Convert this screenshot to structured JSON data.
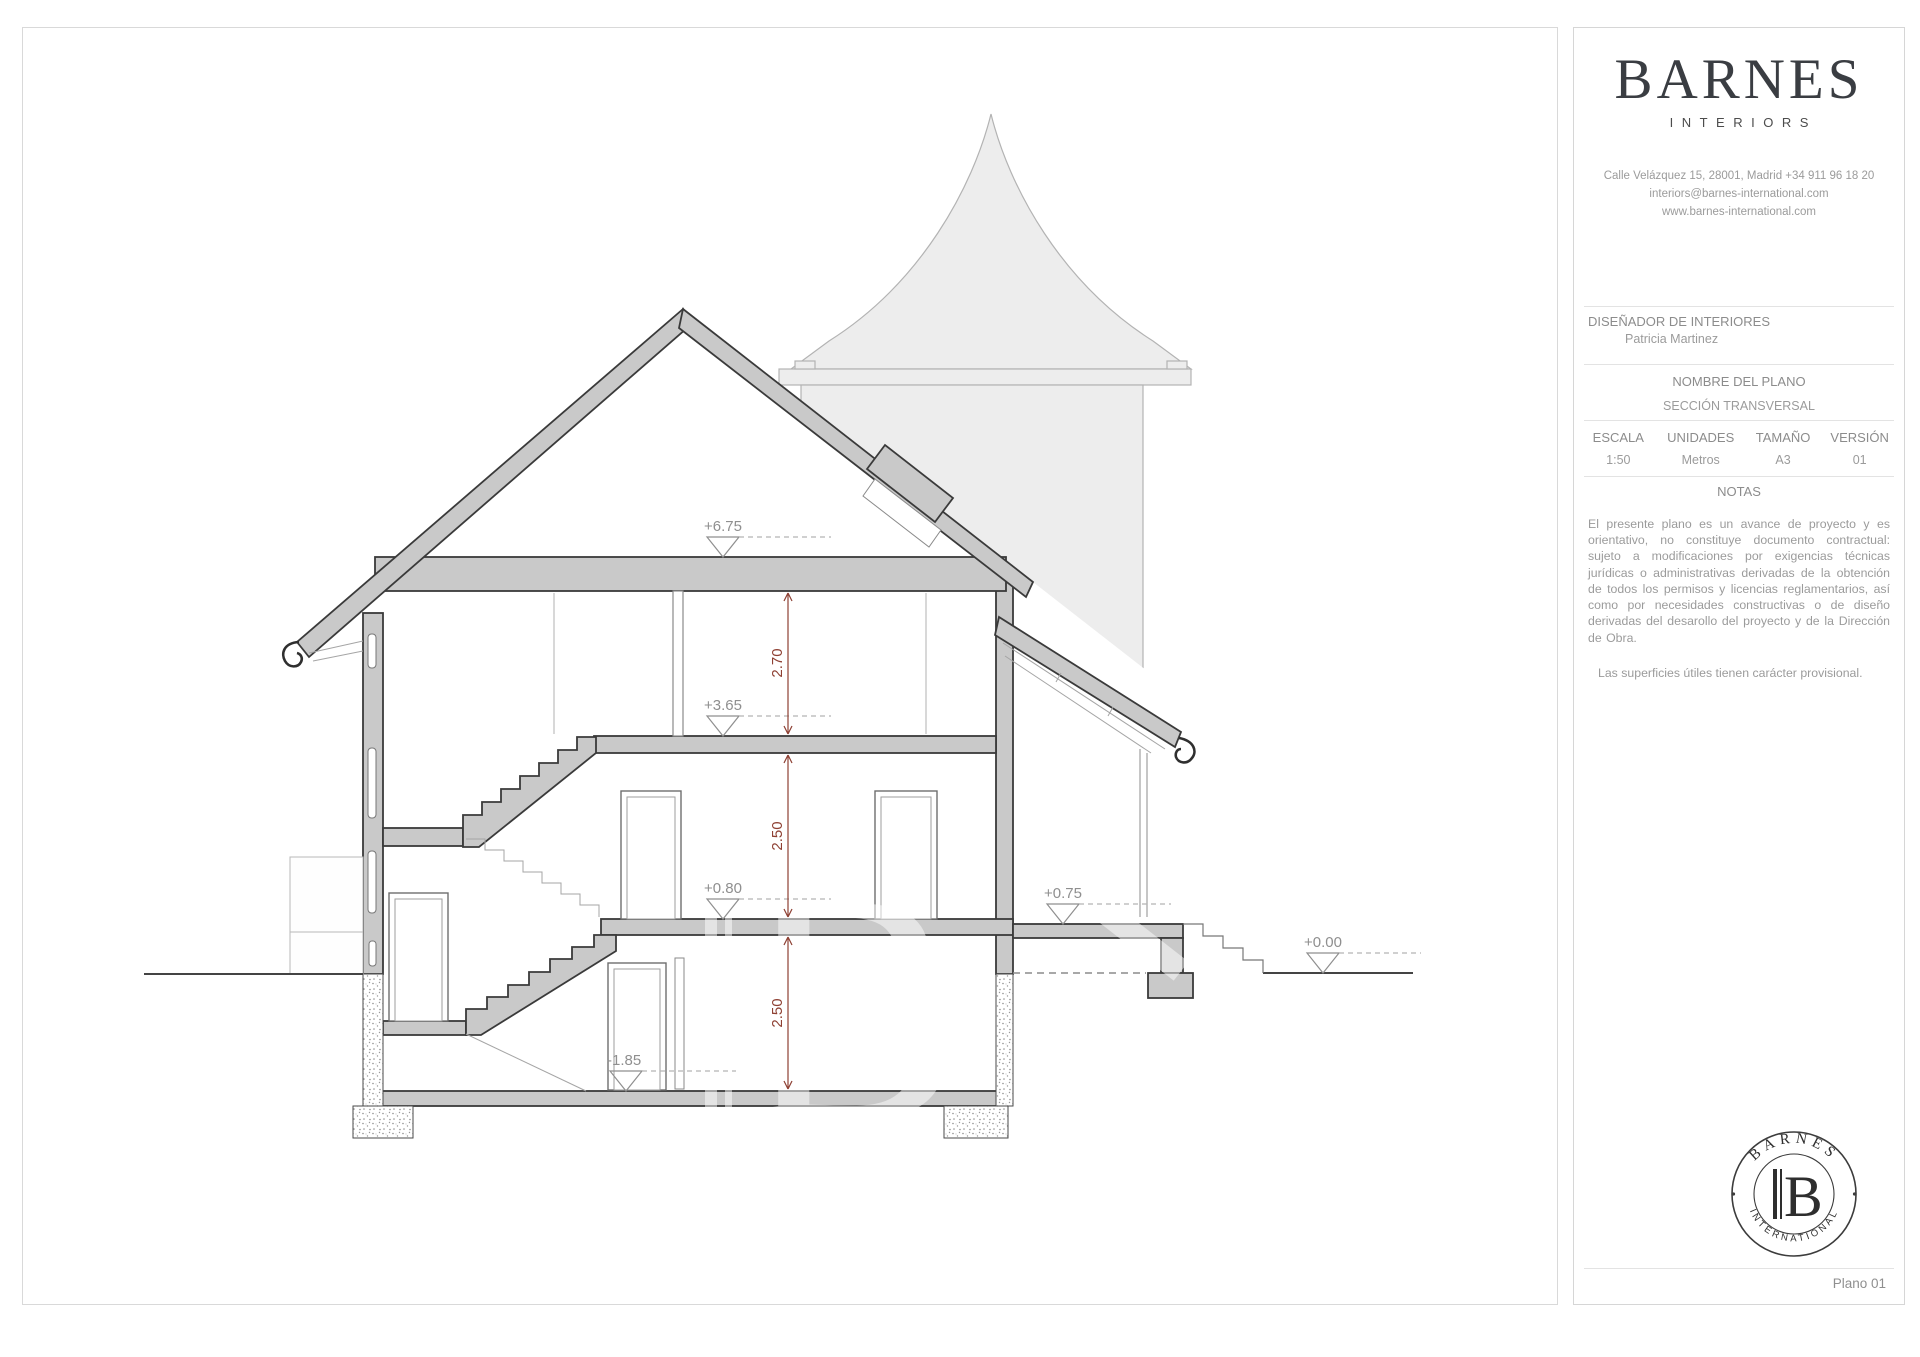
{
  "panel": {
    "brand": {
      "name": "BARNES",
      "subtitle": "INTERIORS"
    },
    "contact": {
      "address": "Calle Velázquez 15, 28001, Madrid +34 911 96 18 20",
      "email": "interiors@barnes-international.com",
      "website": "www.barnes-international.com"
    },
    "designer": {
      "label": "DISEÑADOR DE INTERIORES",
      "name": "Patricia Martinez"
    },
    "plan": {
      "label": "NOMBRE DEL PLANO",
      "name": "SECCIÓN TRANSVERSAL"
    },
    "specs": {
      "headers": [
        "ESCALA",
        "UNIDADES",
        "TAMAÑO",
        "VERSIÓN"
      ],
      "values": [
        "1:50",
        "Metros",
        "A3",
        "01"
      ]
    },
    "notes": {
      "label": "NOTAS",
      "paragraph": "El presente plano es un avance de proyecto y es orientativo, no constituye documento contractual: sujeto a modificaciones por exigencias técnicas jurídicas o administrativas derivadas de la obtención de todos los permisos y licencias reglamentarios, así como por necesidades constructivas o de diseño derivadas del desarollo del proyecto y de la Dirección de Obra.",
      "secondary": "Las superficies útiles tienen carácter provisional."
    },
    "seal": {
      "top": "BARNES",
      "monogram": "B",
      "bottom": "INTERNATIONAL"
    },
    "footer": {
      "page": "Plano 01"
    }
  },
  "drawing": {
    "levels": [
      {
        "id": "attic-ceiling",
        "label": "+6.75"
      },
      {
        "id": "upper-floor",
        "label": "+3.65"
      },
      {
        "id": "main-floor",
        "label": "+0.80"
      },
      {
        "id": "basement",
        "label": "-1.85"
      },
      {
        "id": "terrace",
        "label": "+0.75"
      },
      {
        "id": "grade",
        "label": "+0.00"
      }
    ],
    "dimensions": [
      {
        "label": "2.70"
      },
      {
        "label": "2.50"
      },
      {
        "label": "2.50"
      }
    ],
    "watermark": "B",
    "colors": {
      "wall": "#c9c9c9",
      "outline": "#3a3a3a",
      "background_volume": "#ededed",
      "dimension": "#8e4033"
    }
  }
}
